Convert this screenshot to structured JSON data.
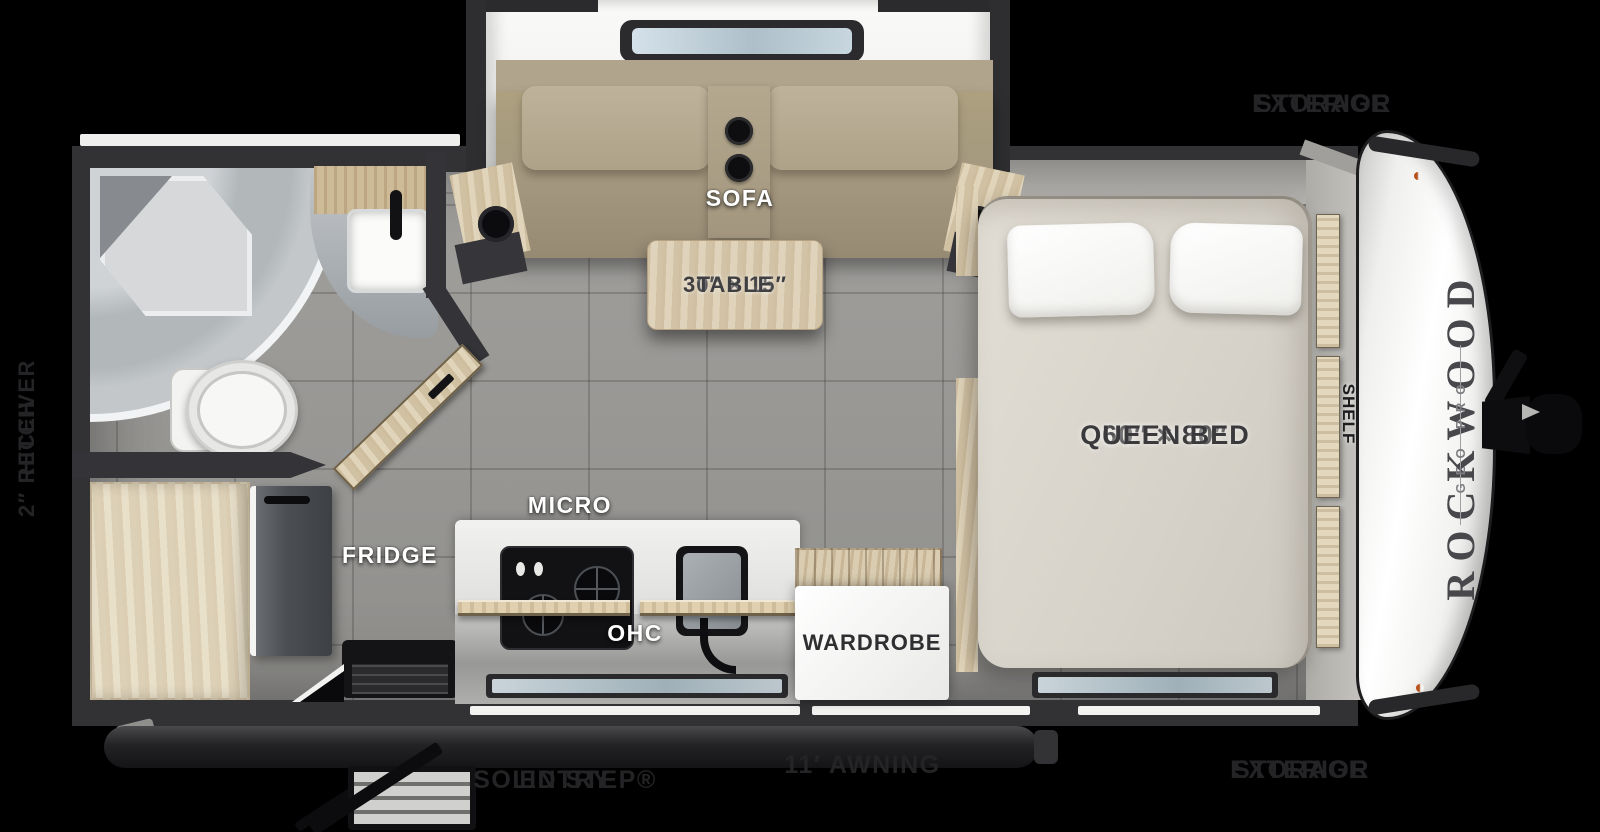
{
  "brand": {
    "name": "ROCKWOOD",
    "sub": "GEO PRO"
  },
  "exterior_labels": {
    "storage_top": {
      "line1": "EXTERIOR",
      "line2": "STORAGE"
    },
    "storage_bottom": {
      "line1": "EXTERIOR",
      "line2": "STORAGE"
    },
    "receiver_hitch": {
      "line1": "2″ RECEIVER",
      "line2": "HITCH"
    },
    "awning": "11′ AWNING",
    "entry": {
      "line1": "SOLID STEP®",
      "line2": "ENTRY"
    }
  },
  "interior_labels": {
    "sofa": "SOFA",
    "table_line1": "30″ × 15″",
    "table_line2": "TABLE",
    "micro": "MICRO",
    "fridge": "FRIDGE",
    "ohc": "OHC",
    "wardrobe": "WARDROBE",
    "bed_line1": "60″ × 80″",
    "bed_line2": "QUEEN BED",
    "shelf": "SHELF"
  },
  "colors": {
    "background": "#000000",
    "walls": "#323235",
    "floor_tile": "#a7a6a3",
    "wood": "#ddcfb2",
    "sofa_fabric": "#aca07f",
    "mattress": "#d9d5cc",
    "front_cap": "#f4f4f2",
    "exterior_text": "#242427"
  }
}
